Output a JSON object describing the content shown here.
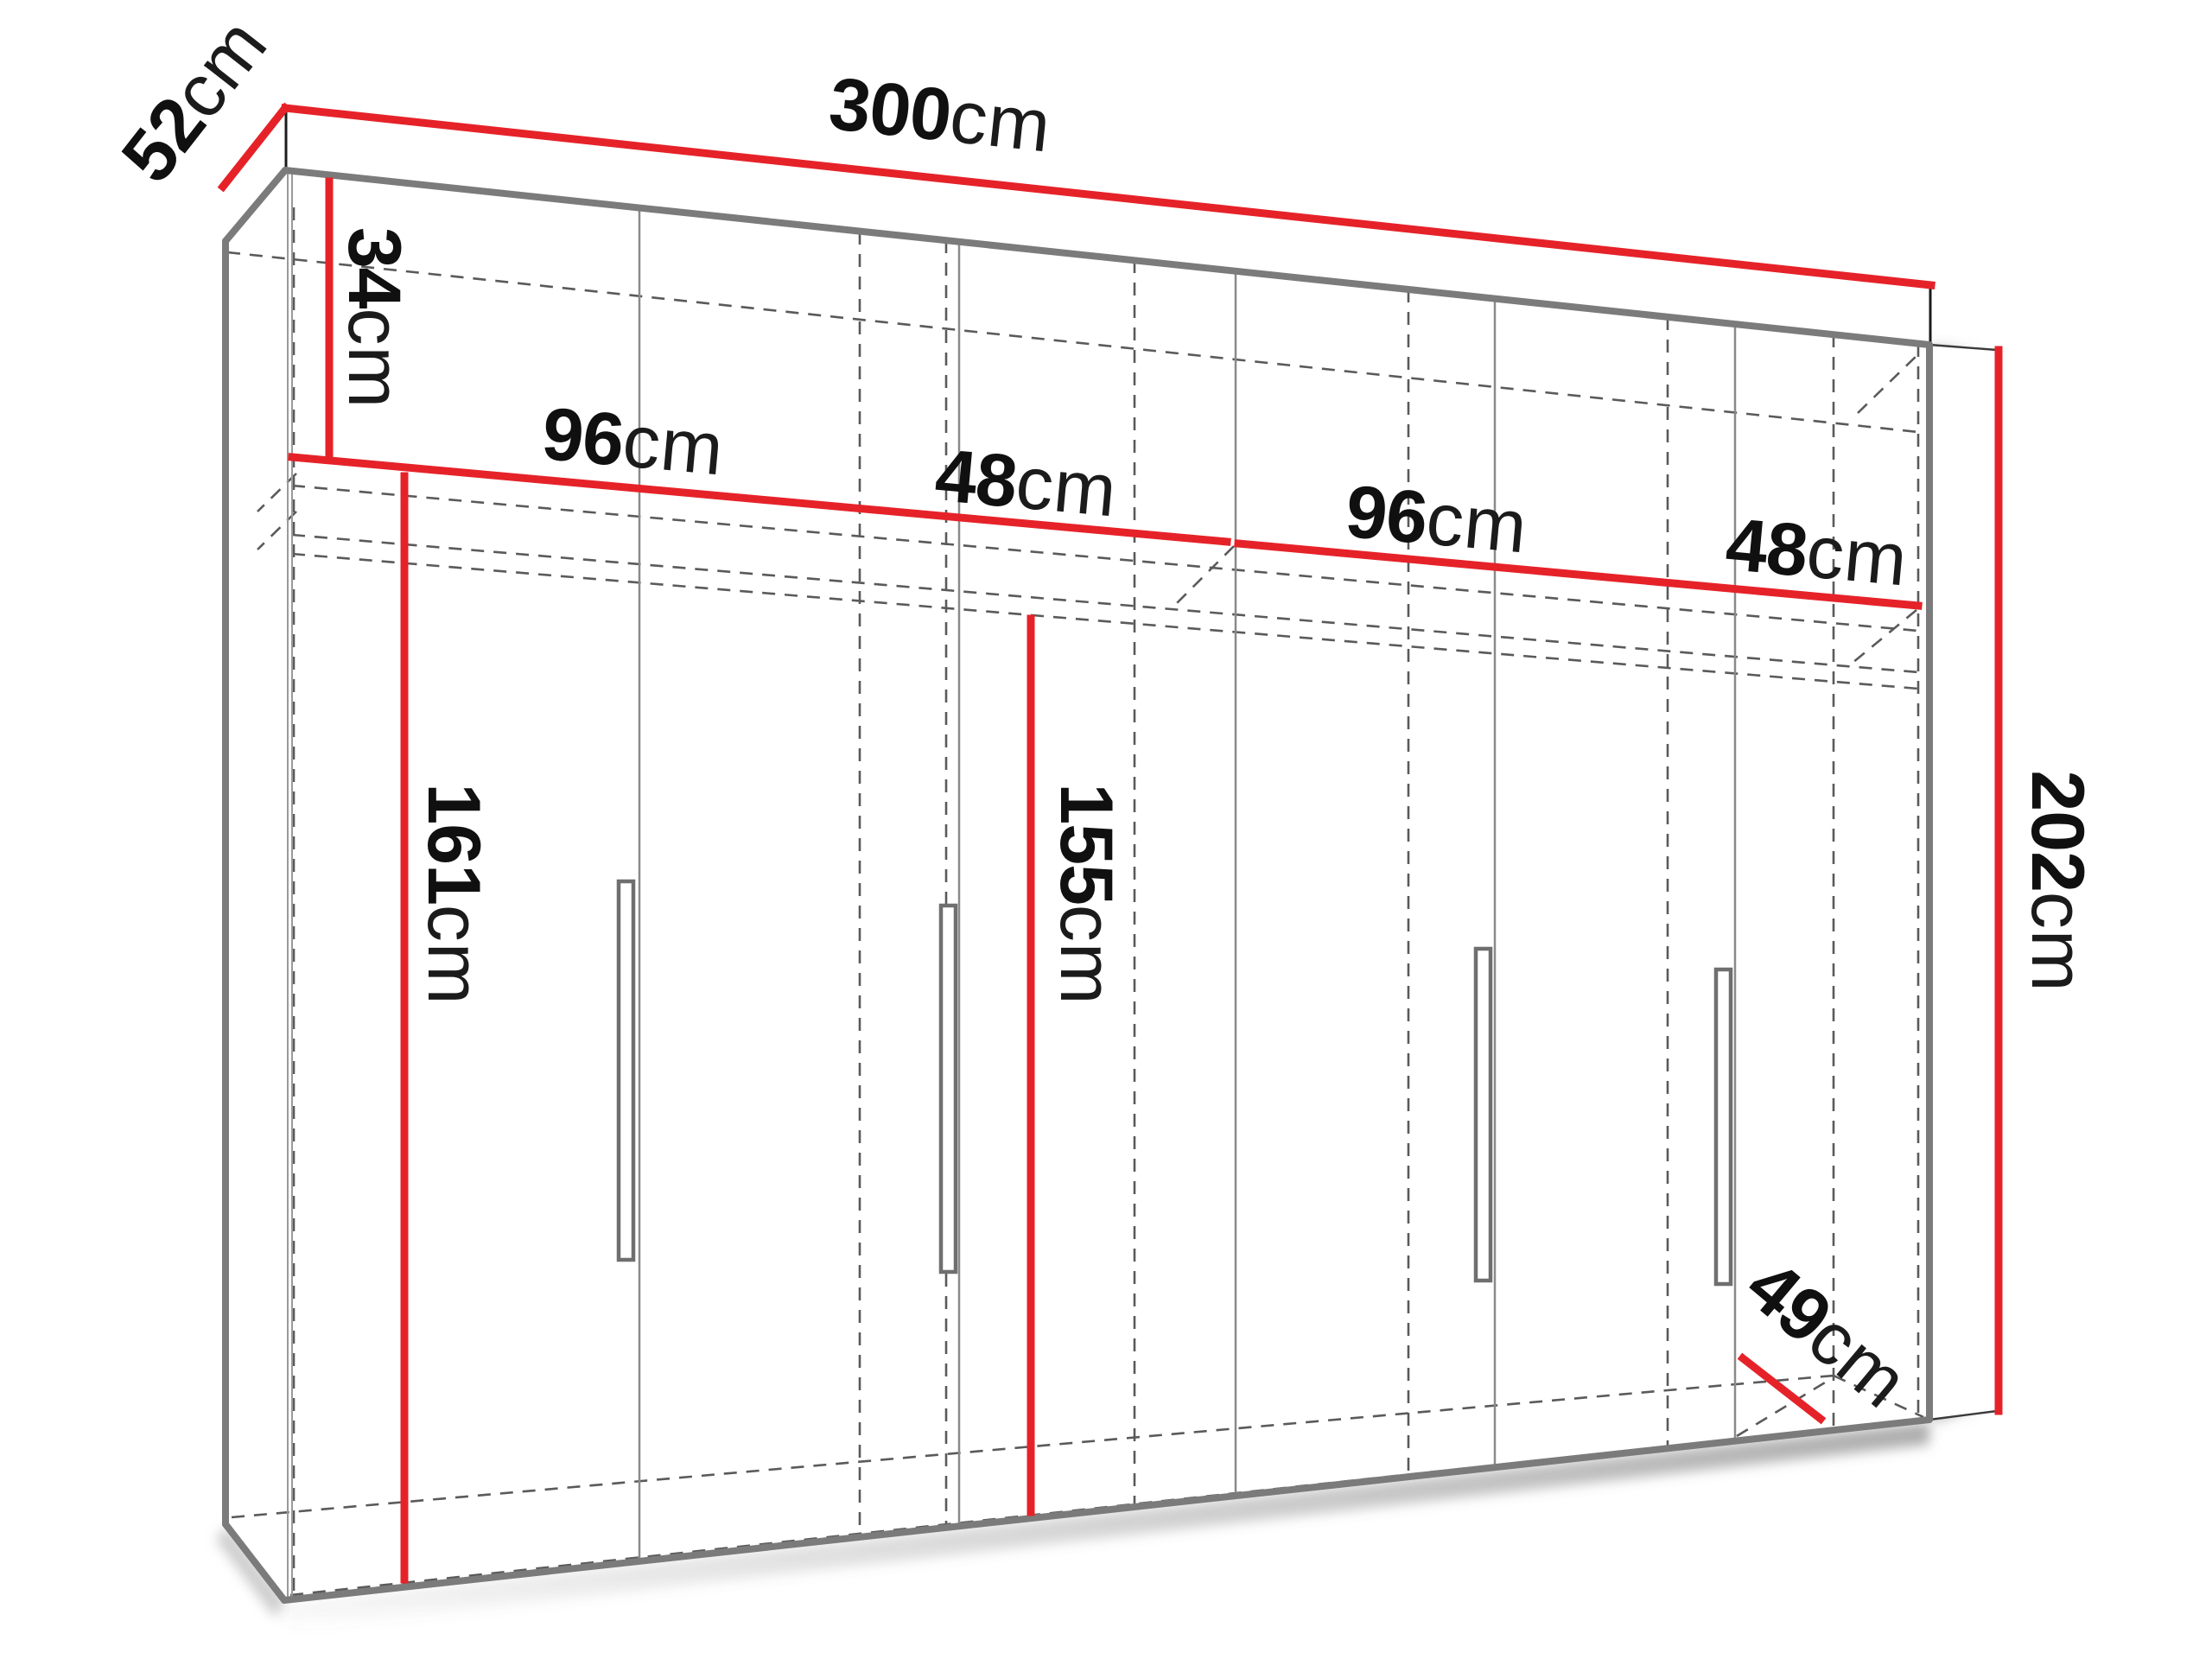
{
  "colors": {
    "dimension": "#e62229",
    "structure": "#7b7b7b",
    "hidden": "#5a5a5a",
    "edge": "#1c1c1c",
    "handle": "#6f6f6f",
    "shadow": "#8c8c8c"
  },
  "dimensions": {
    "depth_top": {
      "num": "52",
      "unit": "cm"
    },
    "width": {
      "num": "300",
      "unit": "cm"
    },
    "top_section_height": {
      "num": "34",
      "unit": "cm"
    },
    "section_widths": [
      {
        "num": "96",
        "unit": "cm"
      },
      {
        "num": "48",
        "unit": "cm"
      },
      {
        "num": "96",
        "unit": "cm"
      },
      {
        "num": "48",
        "unit": "cm"
      }
    ],
    "height": {
      "num": "202",
      "unit": "cm"
    },
    "left_interior_height": {
      "num": "161",
      "unit": "cm"
    },
    "center_interior_height": {
      "num": "155",
      "unit": "cm"
    },
    "depth_bottom": {
      "num": "49",
      "unit": "cm"
    }
  }
}
